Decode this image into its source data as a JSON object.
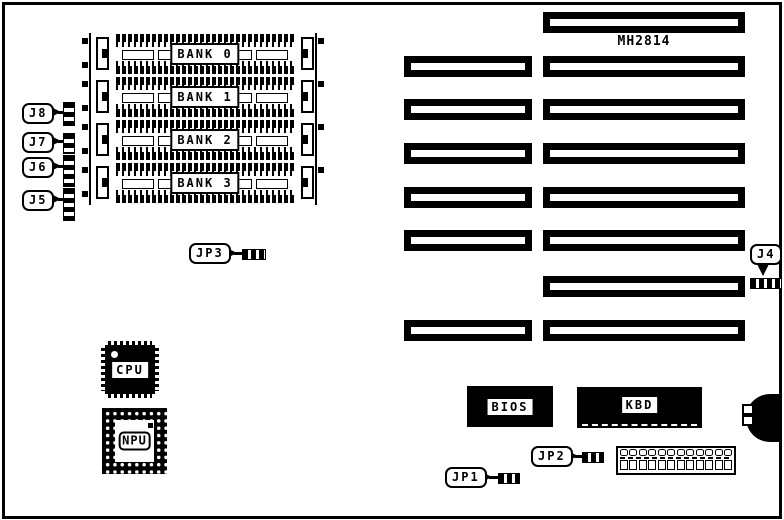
{
  "diagram": {
    "part_number": "MH2814",
    "memory_banks": [
      {
        "label": "BANK 0"
      },
      {
        "label": "BANK 1"
      },
      {
        "label": "BANK 2"
      },
      {
        "label": "BANK 3"
      }
    ],
    "jumpers": {
      "j8": "J8",
      "j7": "J7",
      "j6": "J6",
      "j5": "J5",
      "j4": "J4",
      "jp3": "JP3",
      "jp2": "JP2",
      "jp1": "JP1"
    },
    "chips": {
      "cpu": "CPU",
      "npu": "NPU",
      "bios": "BIOS",
      "kbd": "KBD"
    }
  }
}
